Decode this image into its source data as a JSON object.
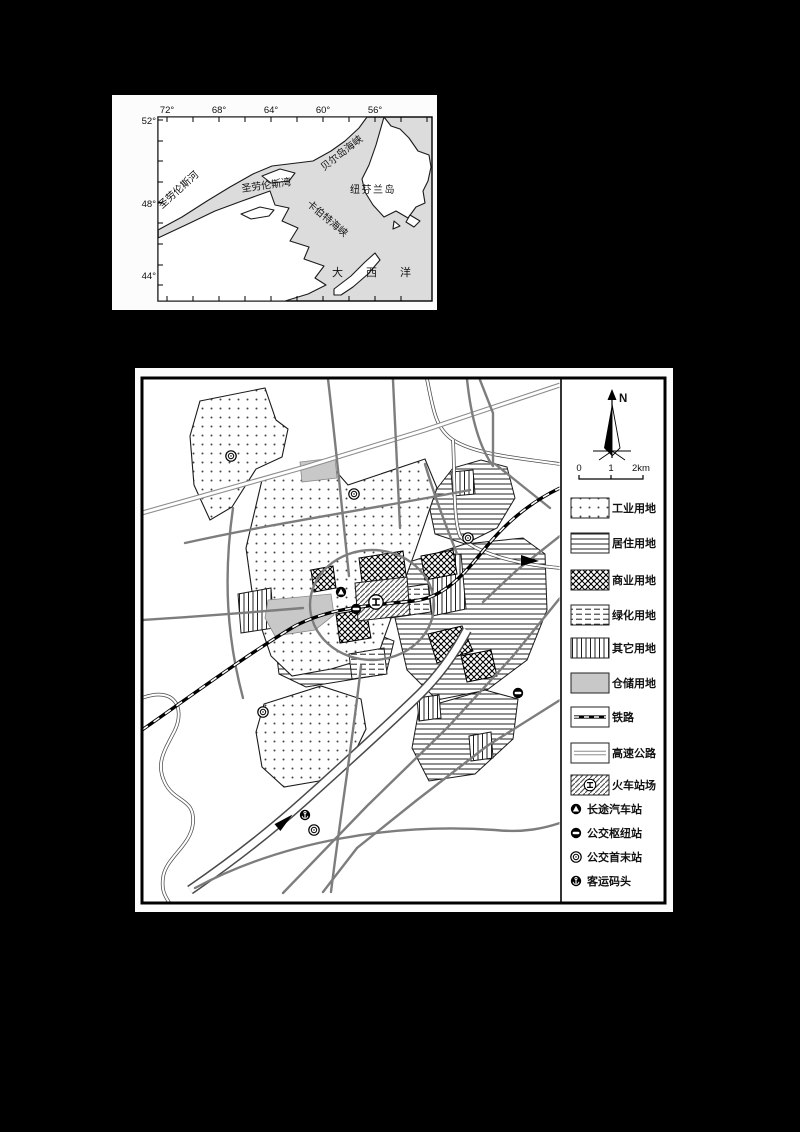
{
  "page": {
    "background_color": "#000000",
    "paper_color": "#fcfcfc"
  },
  "regional_map": {
    "lon_labels": [
      "72°",
      "68°",
      "64°",
      "60°",
      "56°"
    ],
    "lat_labels": [
      "52°",
      "48°",
      "44°"
    ],
    "labels": {
      "st_lawrence_river": "圣劳伦斯河",
      "belle_isle_strait": "贝尔岛海峡",
      "gulf_st_lawrence": "圣劳伦斯湾",
      "newfoundland": "纽芬兰岛",
      "cabot_strait": "卡伯特海峡",
      "atlantic_ocean": "大西洋"
    },
    "water_color": "#dcdcdc",
    "land_color": "#ffffff"
  },
  "city_map": {
    "compass_label": "N",
    "scale_labels": [
      "0",
      "1",
      "2km"
    ],
    "legend": [
      {
        "key": "industrial-land",
        "label": "工业用地",
        "swatch": "dots-pattern"
      },
      {
        "key": "residential-land",
        "label": "居住用地",
        "swatch": "hlines-pattern"
      },
      {
        "key": "commercial-land",
        "label": "商业用地",
        "swatch": "crosshatch-pattern"
      },
      {
        "key": "green-land",
        "label": "绿化用地",
        "swatch": "dashed-lines-pattern"
      },
      {
        "key": "other-land",
        "label": "其它用地",
        "swatch": "vlines-pattern"
      },
      {
        "key": "warehouse-land",
        "label": "仓储用地",
        "swatch": "gray-fill"
      },
      {
        "key": "railway",
        "label": "铁路",
        "swatch": "railway-line"
      },
      {
        "key": "expressway",
        "label": "高速公路",
        "swatch": "double-line"
      },
      {
        "key": "railway-station-yard",
        "label": "火车站场",
        "swatch": "hatch-station"
      },
      {
        "key": "long-distance-bus-station",
        "label": "长途汽车站",
        "swatch": "circle-triangle-icon"
      },
      {
        "key": "bus-hub-station",
        "label": "公交枢纽站",
        "swatch": "circle-bar-icon"
      },
      {
        "key": "bus-terminal-station",
        "label": "公交首末站",
        "swatch": "double-circle-icon"
      },
      {
        "key": "passenger-wharf",
        "label": "客运码头",
        "swatch": "circle-anchor-icon"
      }
    ],
    "warehouse_color": "#c8c8c8",
    "road_color": "#7d7d7d",
    "railway_color": "#000000"
  }
}
